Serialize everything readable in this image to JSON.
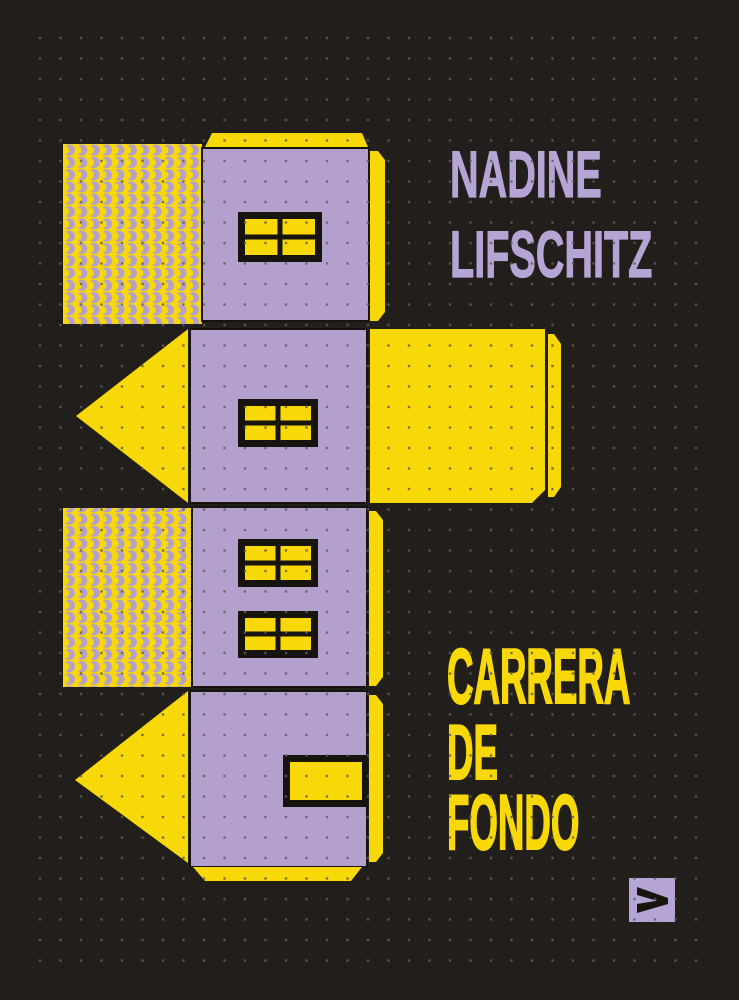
{
  "cover": {
    "author": {
      "lines": [
        "NADINE",
        "LIFSCHITZ"
      ]
    },
    "title": {
      "lines": [
        "CARRERA",
        "DE",
        "FONDO"
      ]
    },
    "illustration": "paper-house-cutout-net",
    "publisher_mark": "chevron-logo"
  },
  "colors": {
    "background": "#211e1c",
    "yellow": "#f8d806",
    "lavender": "#b3a0cd",
    "lavender_text": "#b6a4d4",
    "frame_black": "#17140f",
    "dot": "#605d55"
  }
}
